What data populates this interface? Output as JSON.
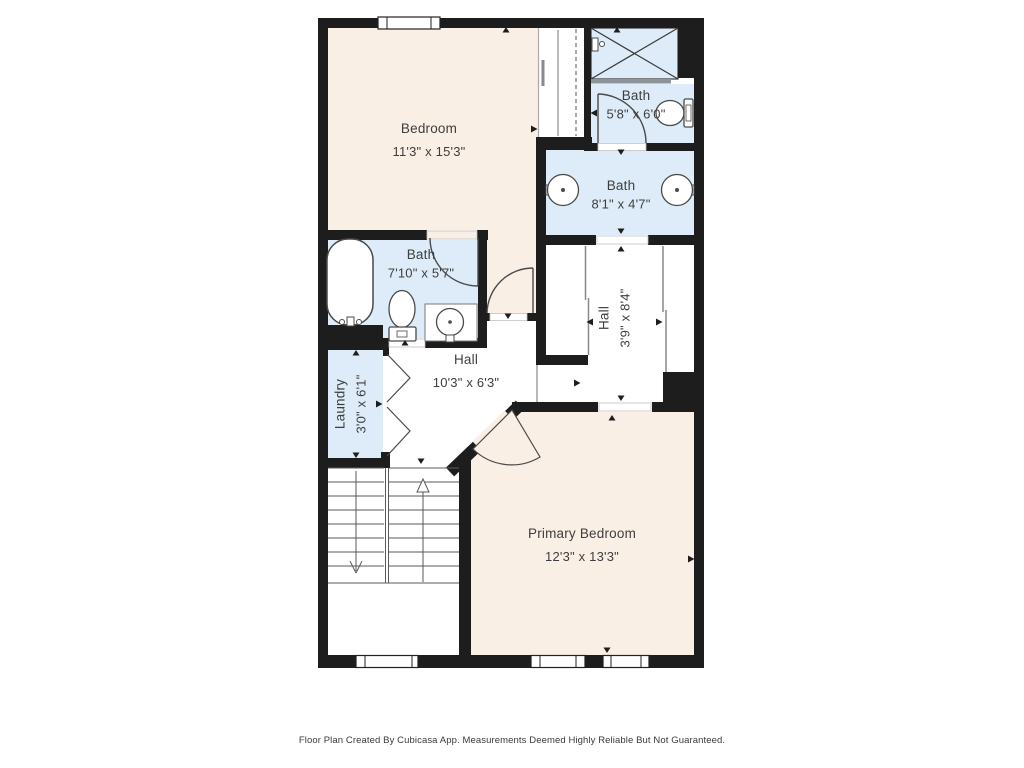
{
  "plan": {
    "rooms": [
      {
        "id": "bedroom",
        "name": "Bedroom",
        "dims": "11'3\" x 15'3\""
      },
      {
        "id": "bath-upper",
        "name": "Bath",
        "dims": "5'8\" x 6'0\""
      },
      {
        "id": "bath-double",
        "name": "Bath",
        "dims": "8'1\" x 4'7\""
      },
      {
        "id": "bath-left",
        "name": "Bath",
        "dims": "7'10\" x 5'7\""
      },
      {
        "id": "hall-right",
        "name": "Hall",
        "dims": "3'9\" x 8'4\""
      },
      {
        "id": "hall-center",
        "name": "Hall",
        "dims": "10'3\" x 6'3\""
      },
      {
        "id": "laundry",
        "name": "Laundry",
        "dims": "3'0\" x 6'1\""
      },
      {
        "id": "primary-bedroom",
        "name": "Primary Bedroom",
        "dims": "12'3\" x 13'3\""
      }
    ]
  },
  "colors": {
    "wall": "#1d1d1d",
    "room_warm": "#f9efe5",
    "room_wet": "#ddecf8",
    "fixture_line": "#4a4a4a",
    "glass": "#8d9499",
    "label_text": "#3e3e3e"
  },
  "footer": {
    "text": "Floor Plan Created By Cubicasa App. Measurements Deemed Highly Reliable But Not Guaranteed."
  }
}
